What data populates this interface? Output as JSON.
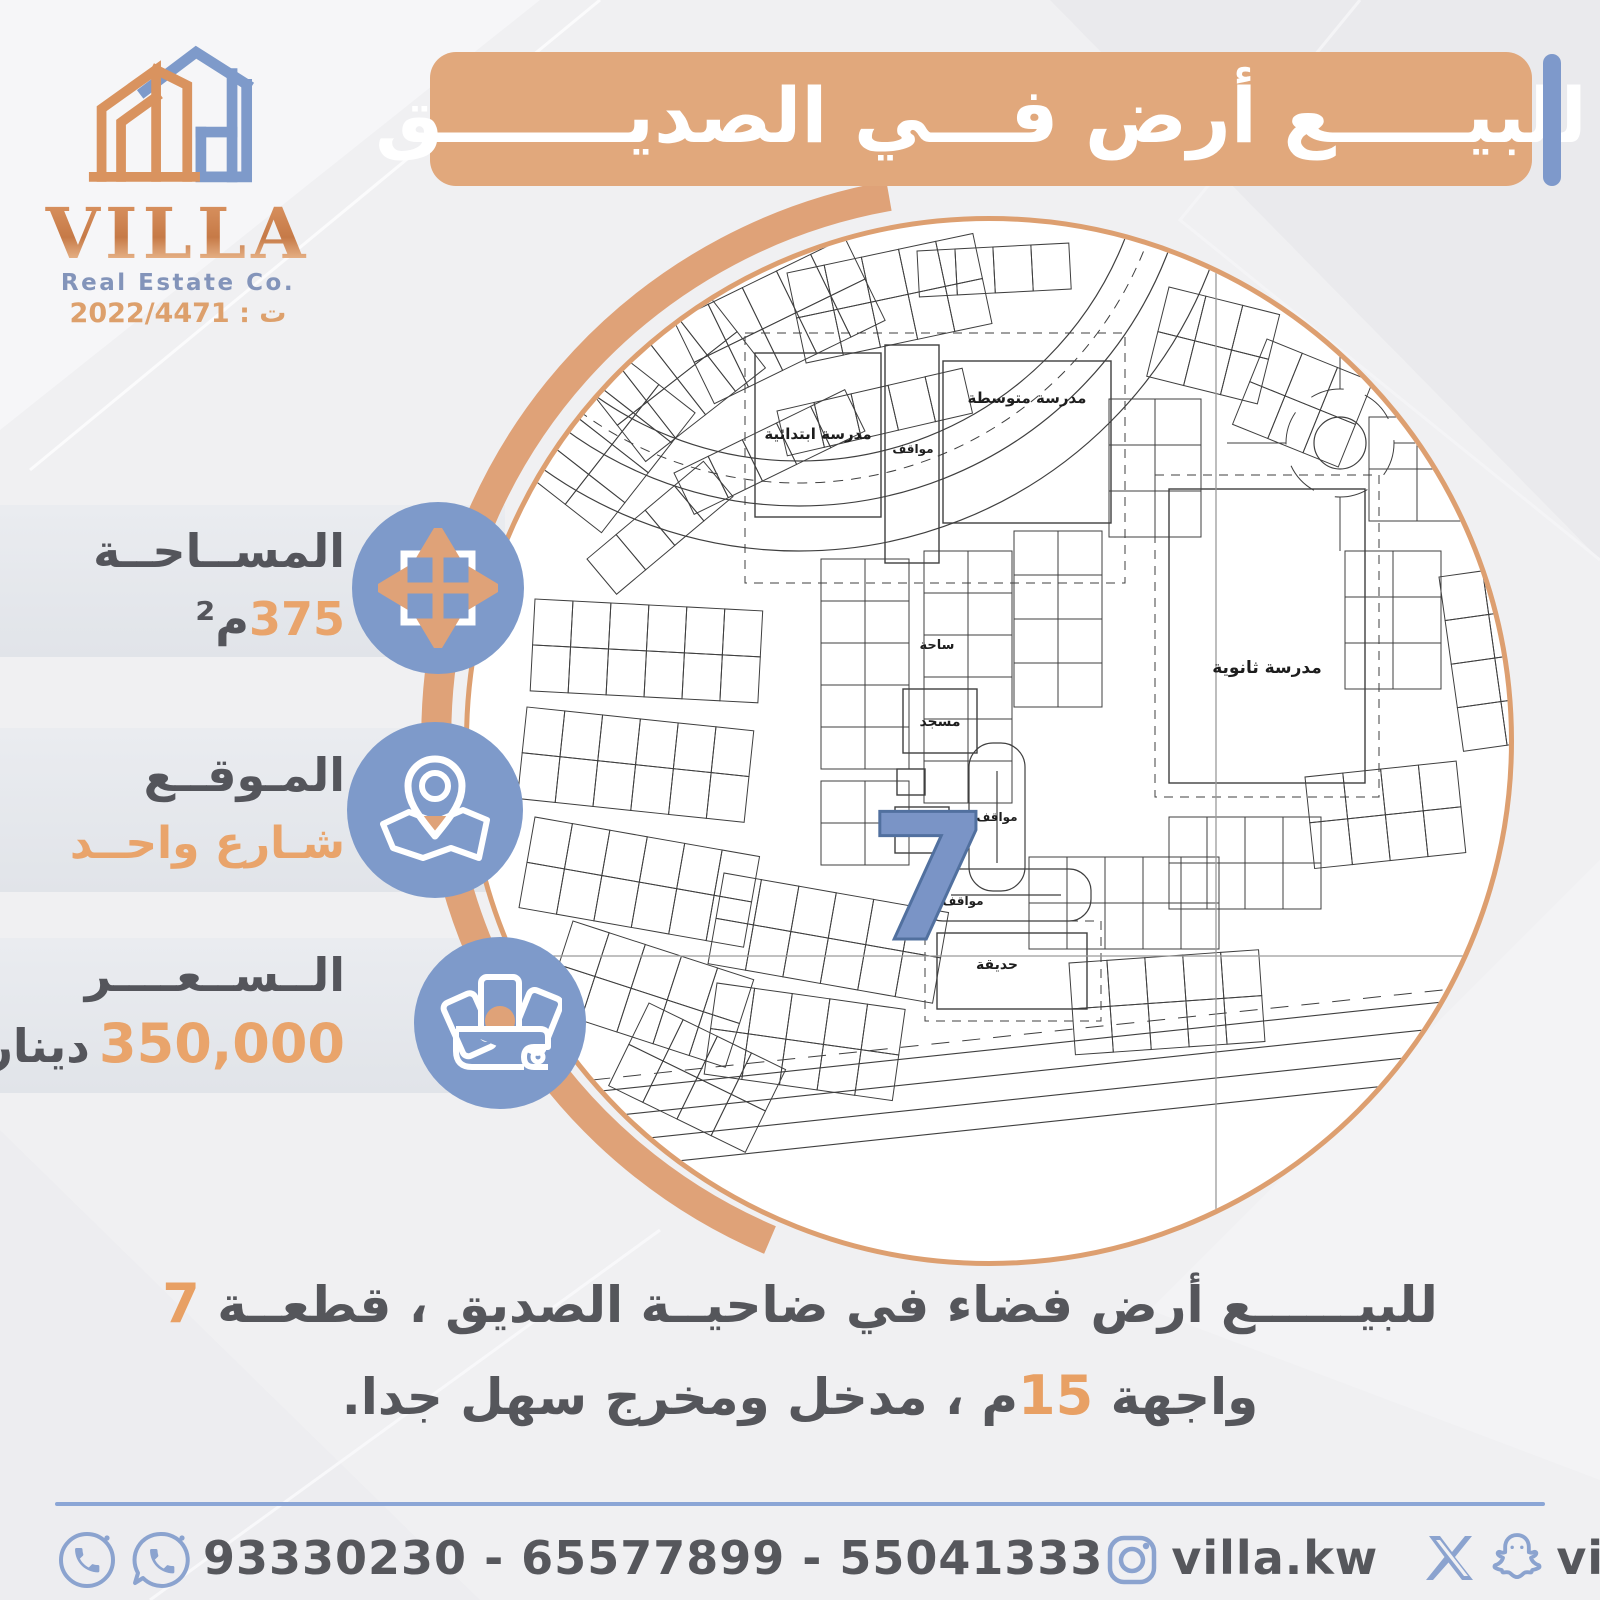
{
  "brand": {
    "name": "VILLA",
    "subtitle": "Real Estate Co.",
    "license": "ت : 2022/4471"
  },
  "header": {
    "title": "للبيـــــع أرض فـــي الصديـــــــق"
  },
  "info": [
    {
      "id": "area",
      "label": "المســاحــة",
      "value": "375",
      "unit": "م²",
      "icon": "expand-arrows-icon"
    },
    {
      "id": "location",
      "label": "المـوقــع",
      "value": "شـارع واحــد",
      "unit": "",
      "icon": "map-pin-icon"
    },
    {
      "id": "price",
      "label": "الــســعــــر",
      "value": "350,000",
      "unit": "دينار",
      "icon": "money-icon"
    }
  ],
  "description": {
    "line1_text": "للبيــــــع أرض فضاء في ضاحيــة الصديق ، قطعــة ",
    "line1_highlight": "7",
    "line2_prefix": "واجهة ",
    "line2_highlight": "15",
    "line2_suffix": "م ، مدخل ومخرج سهل جدا."
  },
  "footer": {
    "phones": "93330230 - 65577899 - 55041333",
    "instagram_handle": "villa.kw",
    "social_handle": "villa_kw"
  },
  "map": {
    "plot_number": "7",
    "labels": [
      {
        "t": "مدرسة ابتدائية",
        "x": 349,
        "y": 218,
        "s": 15
      },
      {
        "t": "مواقف",
        "x": 444,
        "y": 232,
        "s": 12
      },
      {
        "t": "مدرسة متوسطة",
        "x": 558,
        "y": 182,
        "s": 15
      },
      {
        "t": "مدرسة ثانوية",
        "x": 798,
        "y": 452,
        "s": 17
      },
      {
        "t": "ساحة",
        "x": 468,
        "y": 428,
        "s": 13
      },
      {
        "t": "مسجد",
        "x": 471,
        "y": 505,
        "s": 14
      },
      {
        "t": "مواقف",
        "x": 528,
        "y": 600,
        "s": 12
      },
      {
        "t": "مواقف",
        "x": 494,
        "y": 684,
        "s": 12
      },
      {
        "t": "حديقة",
        "x": 528,
        "y": 748,
        "s": 14
      }
    ]
  },
  "colors": {
    "orange": "#dfa278",
    "orange_text": "#e9a46b",
    "blue": "#7e9aca",
    "dark": "#54555b",
    "footer_line": "#8ba6d6"
  }
}
